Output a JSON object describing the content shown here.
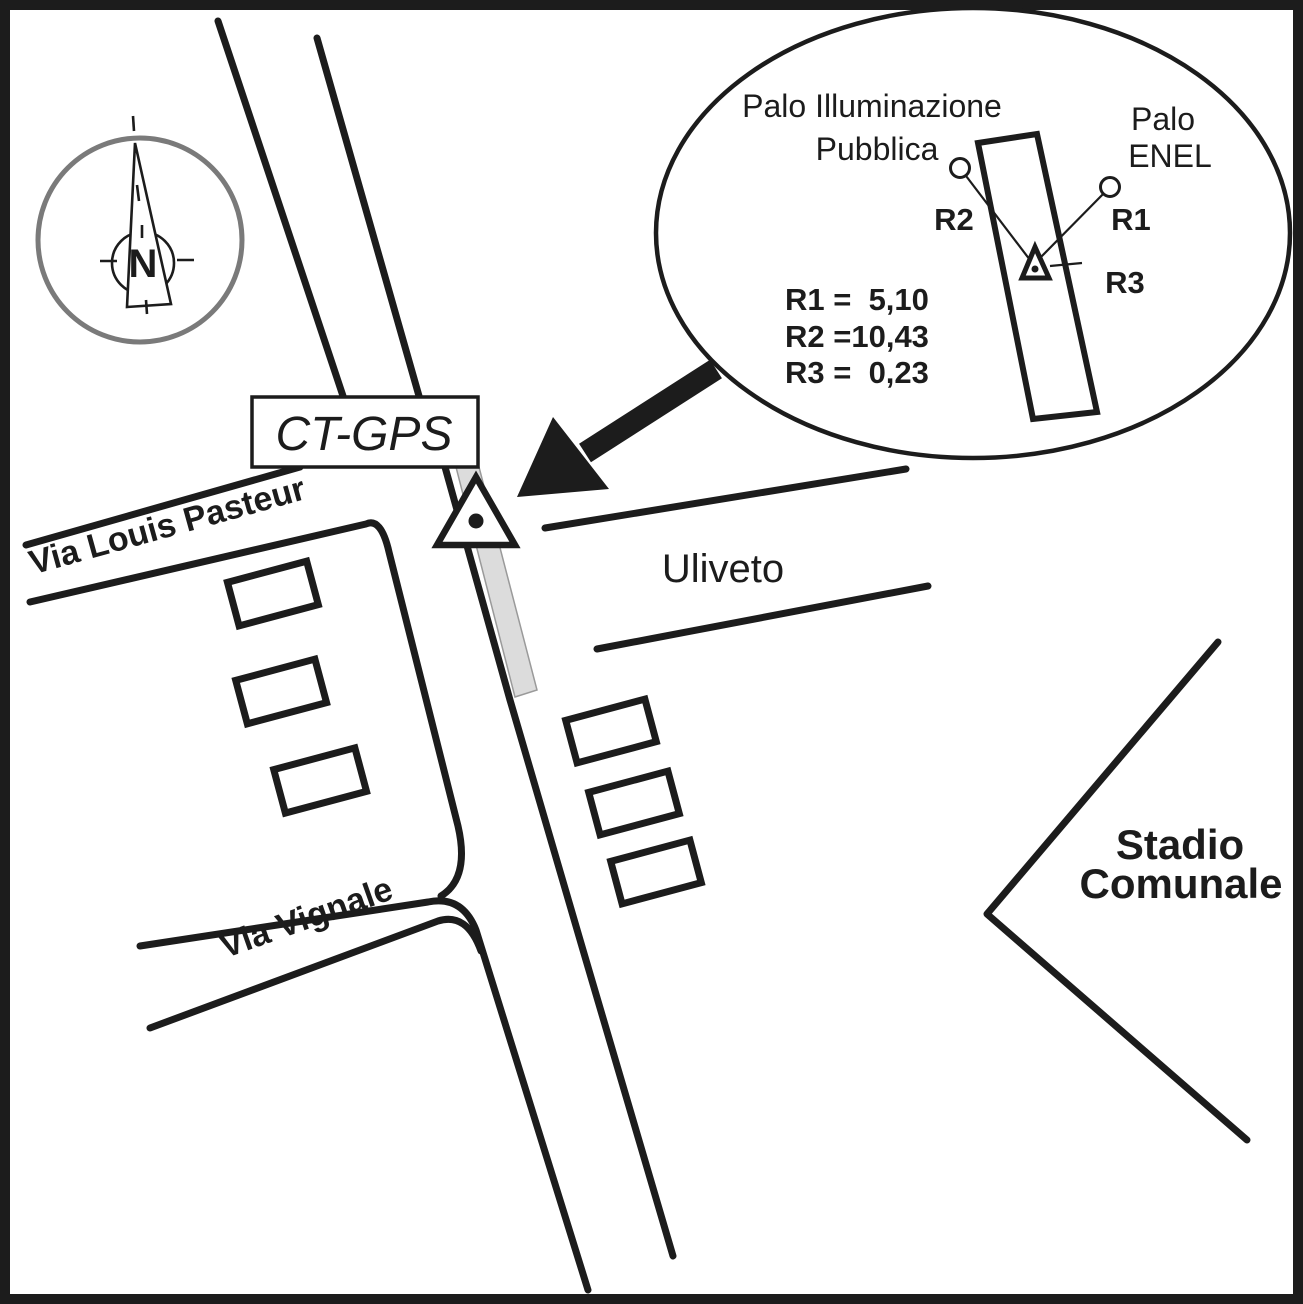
{
  "colors": {
    "ink": "#1c1c1c",
    "compass_ring_gray": "#7a7a7a",
    "wall_strip_fill": "#dcdcdc",
    "wall_strip_edge": "#9a9a9a",
    "background": "#ffffff"
  },
  "compass": {
    "north_label": "N"
  },
  "station": {
    "box_label": "CT-GPS"
  },
  "streets": {
    "pasteur_label": "Via Louis Pasteur",
    "vignale_label": "Via Vignale",
    "uliveto_label": "Uliveto"
  },
  "places": {
    "stadium_label_line1": "Stadio",
    "stadium_label_line2": "Comunale"
  },
  "inset": {
    "pole_light_label_line1": "Palo Illuminazione",
    "pole_light_label_line2": "Pubblica",
    "pole_enel_label_line1": "Palo",
    "pole_enel_label_line2": "ENEL",
    "r1_label": "R1",
    "r2_label": "R2",
    "r3_label": "R3",
    "measurements": [
      "R1 =  5,10",
      "R2 =10,43",
      "R3 =  0,23"
    ]
  }
}
